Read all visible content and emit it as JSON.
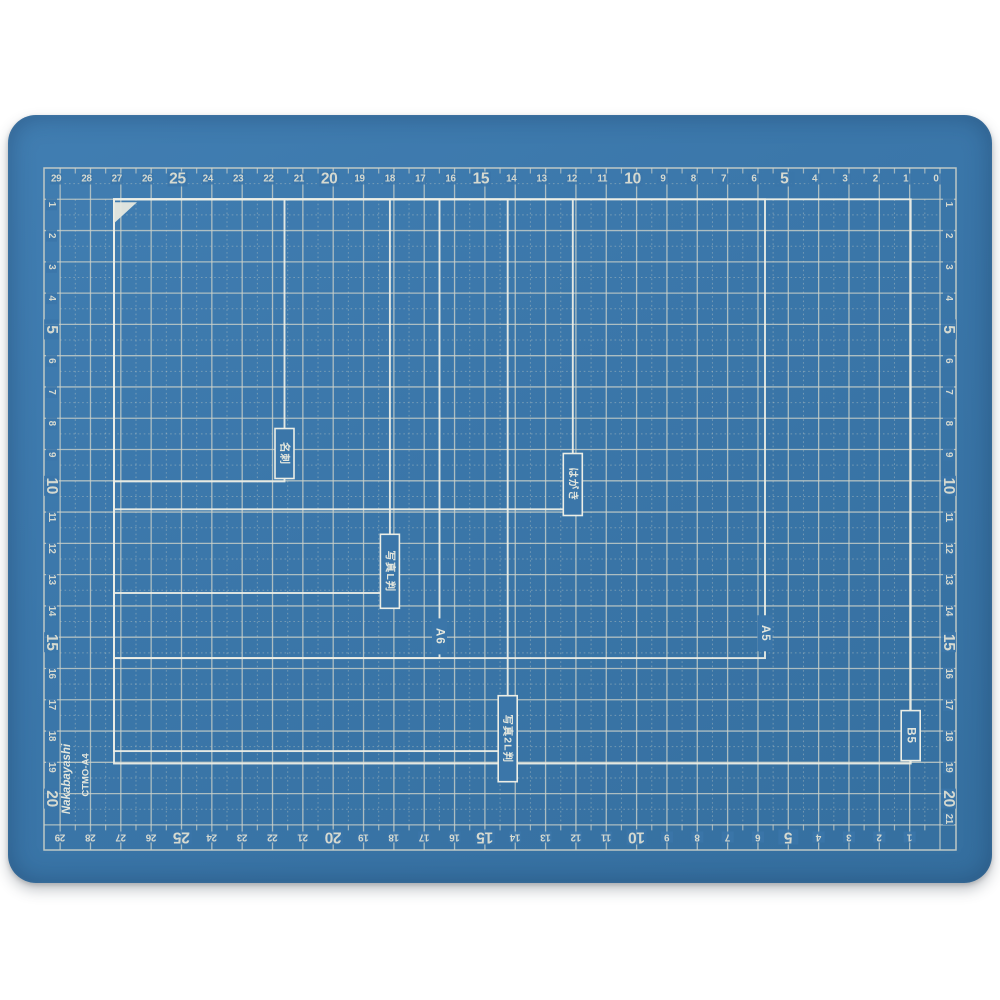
{
  "page": {
    "background_color": "#ffffff"
  },
  "product": {
    "brand": "Nakabayashi",
    "model": "CTMO-A4"
  },
  "mat": {
    "surface_color": "#3b76a9",
    "grid_line_color": "#cdd2c9",
    "outline_color": "#eceee6",
    "number_color": "#d5d9d0",
    "label_text_color": "#e3e6dd",
    "corner_marker_color": "#e6e9e0",
    "rulers": {
      "unit": "cm",
      "top": [
        "29",
        "28",
        "27",
        "26",
        "25",
        "24",
        "23",
        "22",
        "21",
        "20",
        "19",
        "18",
        "17",
        "16",
        "15",
        "14",
        "13",
        "12",
        "11",
        "10",
        "9",
        "8",
        "7",
        "6",
        "5",
        "4",
        "3",
        "2",
        "1",
        "0"
      ],
      "bottom": [
        "29",
        "28",
        "27",
        "26",
        "25",
        "24",
        "23",
        "22",
        "21",
        "20",
        "19",
        "18",
        "17",
        "16",
        "15",
        "14",
        "13",
        "12",
        "11",
        "10",
        "9",
        "8",
        "7",
        "6",
        "5",
        "4",
        "3",
        "2",
        "1"
      ],
      "left": [
        "1",
        "2",
        "3",
        "4",
        "5",
        "6",
        "7",
        "8",
        "9",
        "10",
        "11",
        "12",
        "13",
        "14",
        "15",
        "16",
        "17",
        "18",
        "19",
        "20"
      ],
      "right": [
        "1",
        "2",
        "3",
        "4",
        "5",
        "6",
        "7",
        "8",
        "9",
        "10",
        "11",
        "12",
        "13",
        "14",
        "15",
        "16",
        "17",
        "18",
        "19",
        "20",
        "21"
      ],
      "emphasized_every": 5
    },
    "size_outlines": [
      {
        "id": "business-card",
        "label": "名刺",
        "width_cm": 5.5,
        "height_cm": 9.1,
        "label_center_cm": 8.2,
        "boxed": true
      },
      {
        "id": "photo-l",
        "label": "写真L判",
        "width_cm": 8.9,
        "height_cm": 12.7,
        "label_center_cm": 12.0,
        "boxed": true
      },
      {
        "id": "hagaki-postcard",
        "label": "はがき",
        "width_cm": 14.8,
        "height_cm": 10.0,
        "label_center_cm": 9.2,
        "boxed": true
      },
      {
        "id": "a6",
        "label": "A6",
        "width_cm": 10.5,
        "height_cm": 14.8,
        "label_center_cm": 14.1,
        "boxed": false
      },
      {
        "id": "a5",
        "label": "A5",
        "width_cm": 21.0,
        "height_cm": 14.8,
        "label_center_cm": 14.0,
        "boxed": false
      },
      {
        "id": "photo-2l",
        "label": "写真2L判",
        "width_cm": 12.7,
        "height_cm": 17.8,
        "label_center_cm": 17.4,
        "boxed": true
      },
      {
        "id": "b5",
        "label": "B5",
        "width_cm": 25.7,
        "height_cm": 18.2,
        "label_center_cm": 17.3,
        "boxed": true
      }
    ]
  }
}
